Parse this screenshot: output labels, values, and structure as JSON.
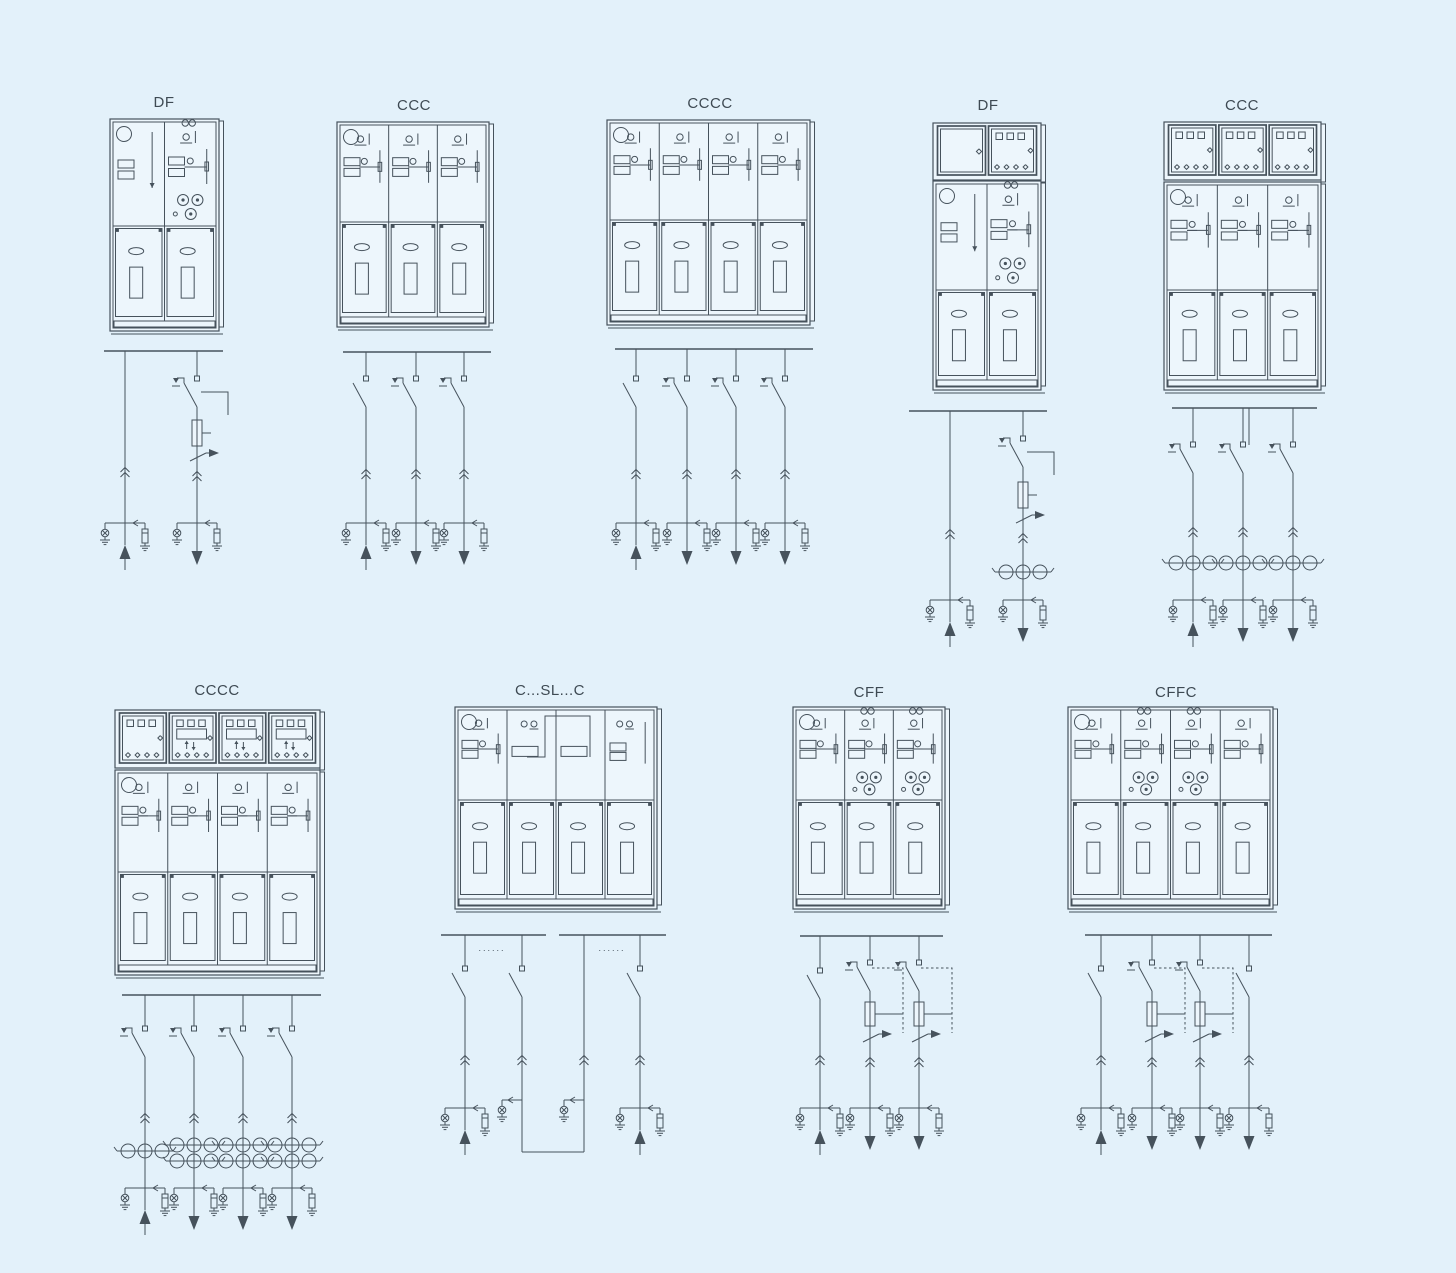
{
  "colors": {
    "background": "#e3f1fa",
    "line": "#46525c",
    "panel_fill": "#edf6fc",
    "label_text": "#3e4a53"
  },
  "units": [
    {
      "label": "DF",
      "cabinet": {
        "panels": [
          "D",
          "F"
        ],
        "lv_boxes": []
      },
      "diagram": {
        "feeders": [
          {
            "kind": "plain",
            "arrow": "up"
          },
          {
            "kind": "switch-fuse",
            "arrow": "down"
          }
        ]
      }
    },
    {
      "label": "CCC",
      "cabinet": {
        "panels": [
          "C",
          "C",
          "C"
        ],
        "lv_boxes": []
      },
      "diagram": {
        "feeders": [
          {
            "kind": "switch",
            "arrow": "up"
          },
          {
            "kind": "switch-earth",
            "arrow": "down"
          },
          {
            "kind": "switch-earth",
            "arrow": "down"
          }
        ]
      }
    },
    {
      "label": "CCCC",
      "cabinet": {
        "panels": [
          "C",
          "C",
          "C",
          "C"
        ],
        "lv_boxes": []
      },
      "diagram": {
        "feeders": [
          {
            "kind": "switch",
            "arrow": "up"
          },
          {
            "kind": "switch-earth",
            "arrow": "down"
          },
          {
            "kind": "switch-earth",
            "arrow": "down"
          },
          {
            "kind": "switch-earth",
            "arrow": "down"
          }
        ]
      }
    },
    {
      "label": "DF",
      "cabinet": {
        "panels": [
          "D",
          "F"
        ],
        "lv_boxes": [
          "window",
          "meter"
        ]
      },
      "diagram": {
        "feeders": [
          {
            "kind": "plain",
            "arrow": "up"
          },
          {
            "kind": "switch-fuse",
            "ct_rows": 1,
            "arrow": "down"
          }
        ]
      }
    },
    {
      "label": "CCC",
      "cabinet": {
        "panels": [
          "C",
          "C",
          "C"
        ],
        "lv_boxes": [
          "meter",
          "meter",
          "meter"
        ]
      },
      "diagram": {
        "feeders": [
          {
            "kind": "switch-earth",
            "ct_rows": 1,
            "arrow": "up"
          },
          {
            "kind": "switch-earth",
            "ct_rows": 1,
            "arrow": "down"
          },
          {
            "kind": "switch-earth",
            "ct_rows": 1,
            "arrow": "down"
          }
        ]
      }
    },
    {
      "label": "CCCC",
      "cabinet": {
        "panels": [
          "C",
          "C",
          "C",
          "C"
        ],
        "lv_boxes": [
          "meter",
          "display",
          "display",
          "display"
        ]
      },
      "diagram": {
        "feeders": [
          {
            "kind": "switch-earth",
            "ct_rows": 1,
            "arrow": "up"
          },
          {
            "kind": "switch-earth",
            "ct_rows": 2,
            "arrow": "down"
          },
          {
            "kind": "switch-earth",
            "ct_rows": 2,
            "arrow": "down"
          },
          {
            "kind": "switch-earth",
            "ct_rows": 2,
            "arrow": "down"
          }
        ]
      }
    },
    {
      "label": "C...SL...C",
      "bus_dots": "......",
      "cabinet": {
        "panels": [
          "C",
          "S",
          "L",
          "C4"
        ],
        "lv_boxes": []
      },
      "diagram": {
        "split_bus": true,
        "feeders": [
          {
            "kind": "switch",
            "arrow": "up"
          },
          {
            "kind": "switch-link"
          },
          {
            "kind": "riser-link"
          },
          {
            "kind": "switch",
            "arrow": "up"
          }
        ]
      }
    },
    {
      "label": "CFF",
      "cabinet": {
        "panels": [
          "C",
          "F",
          "F"
        ],
        "lv_boxes": []
      },
      "diagram": {
        "feeders": [
          {
            "kind": "switch",
            "arrow": "up"
          },
          {
            "kind": "switch-fuse-trip",
            "arrow": "down"
          },
          {
            "kind": "switch-fuse-trip",
            "arrow": "down"
          }
        ]
      }
    },
    {
      "label": "CFFC",
      "cabinet": {
        "panels": [
          "C",
          "F",
          "F",
          "C"
        ],
        "lv_boxes": []
      },
      "diagram": {
        "feeders": [
          {
            "kind": "switch",
            "arrow": "up"
          },
          {
            "kind": "switch-fuse-trip",
            "arrow": "down"
          },
          {
            "kind": "switch-fuse-trip",
            "arrow": "down"
          },
          {
            "kind": "switch",
            "arrow": "down"
          }
        ]
      }
    }
  ]
}
